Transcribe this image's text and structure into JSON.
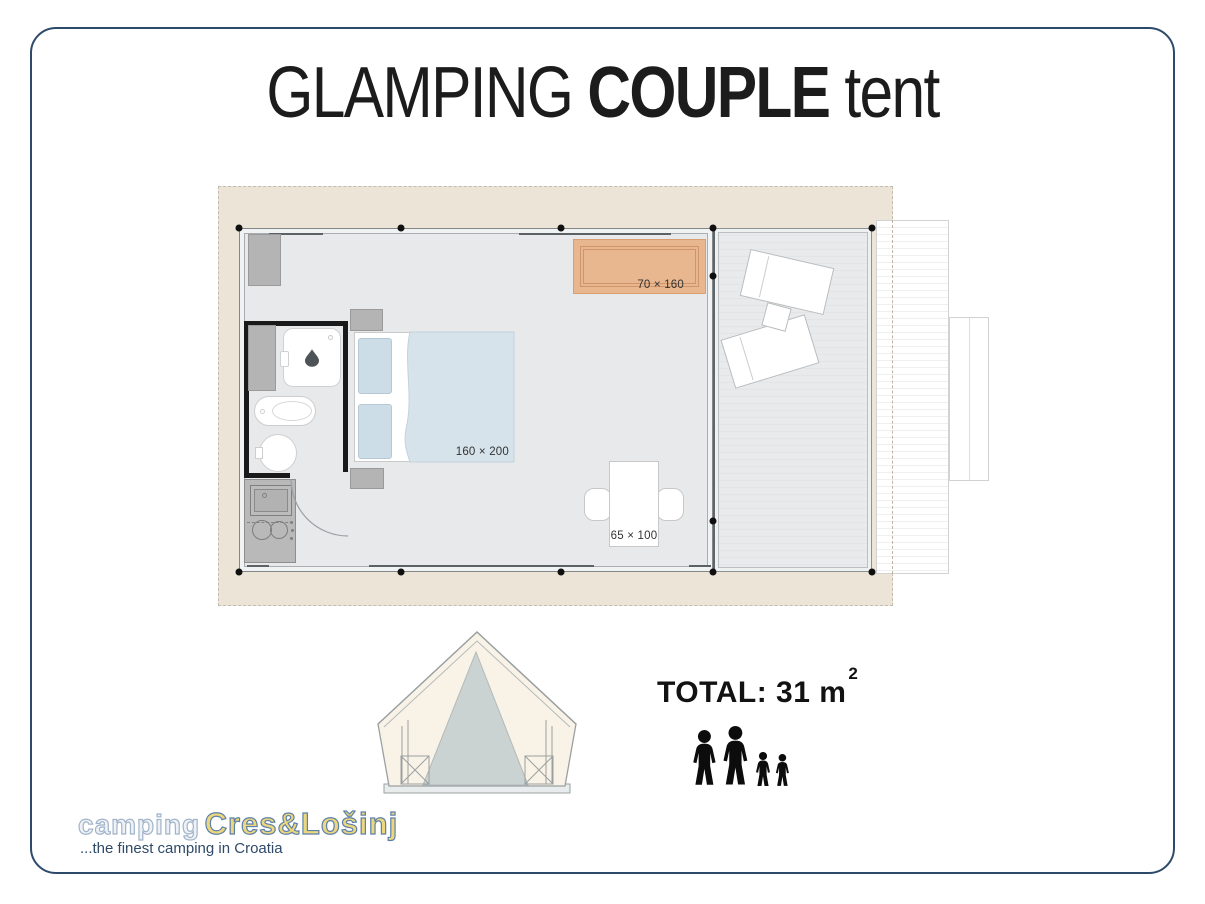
{
  "header": {
    "word1": "GLAMPING",
    "word2": "COUPLE",
    "word3": "tent"
  },
  "floor_plan": {
    "rug_label": "70 × 160",
    "bed_label": "160 × 200",
    "table_label": "65 × 100"
  },
  "summary": {
    "total_text": "TOTAL: 31 m",
    "total_superscript": "2"
  },
  "occupancy": {
    "adults": 2,
    "children": 2
  },
  "branding": {
    "prefix": "camping",
    "name": "Cres&Lošinj",
    "tagline": "...the finest camping in Croatia"
  },
  "colors": {
    "frame_border": "#2d4a6b",
    "canvas_beige": "#ece4d7",
    "floor_gray": "#e8e9eb",
    "rug_orange": "#e9b78f",
    "bed_blue": "#d6e3eb",
    "bathroom_wall": "#1a1a1a",
    "brand_yellow": "#ecd77f",
    "brand_navy": "#2e4a68"
  }
}
